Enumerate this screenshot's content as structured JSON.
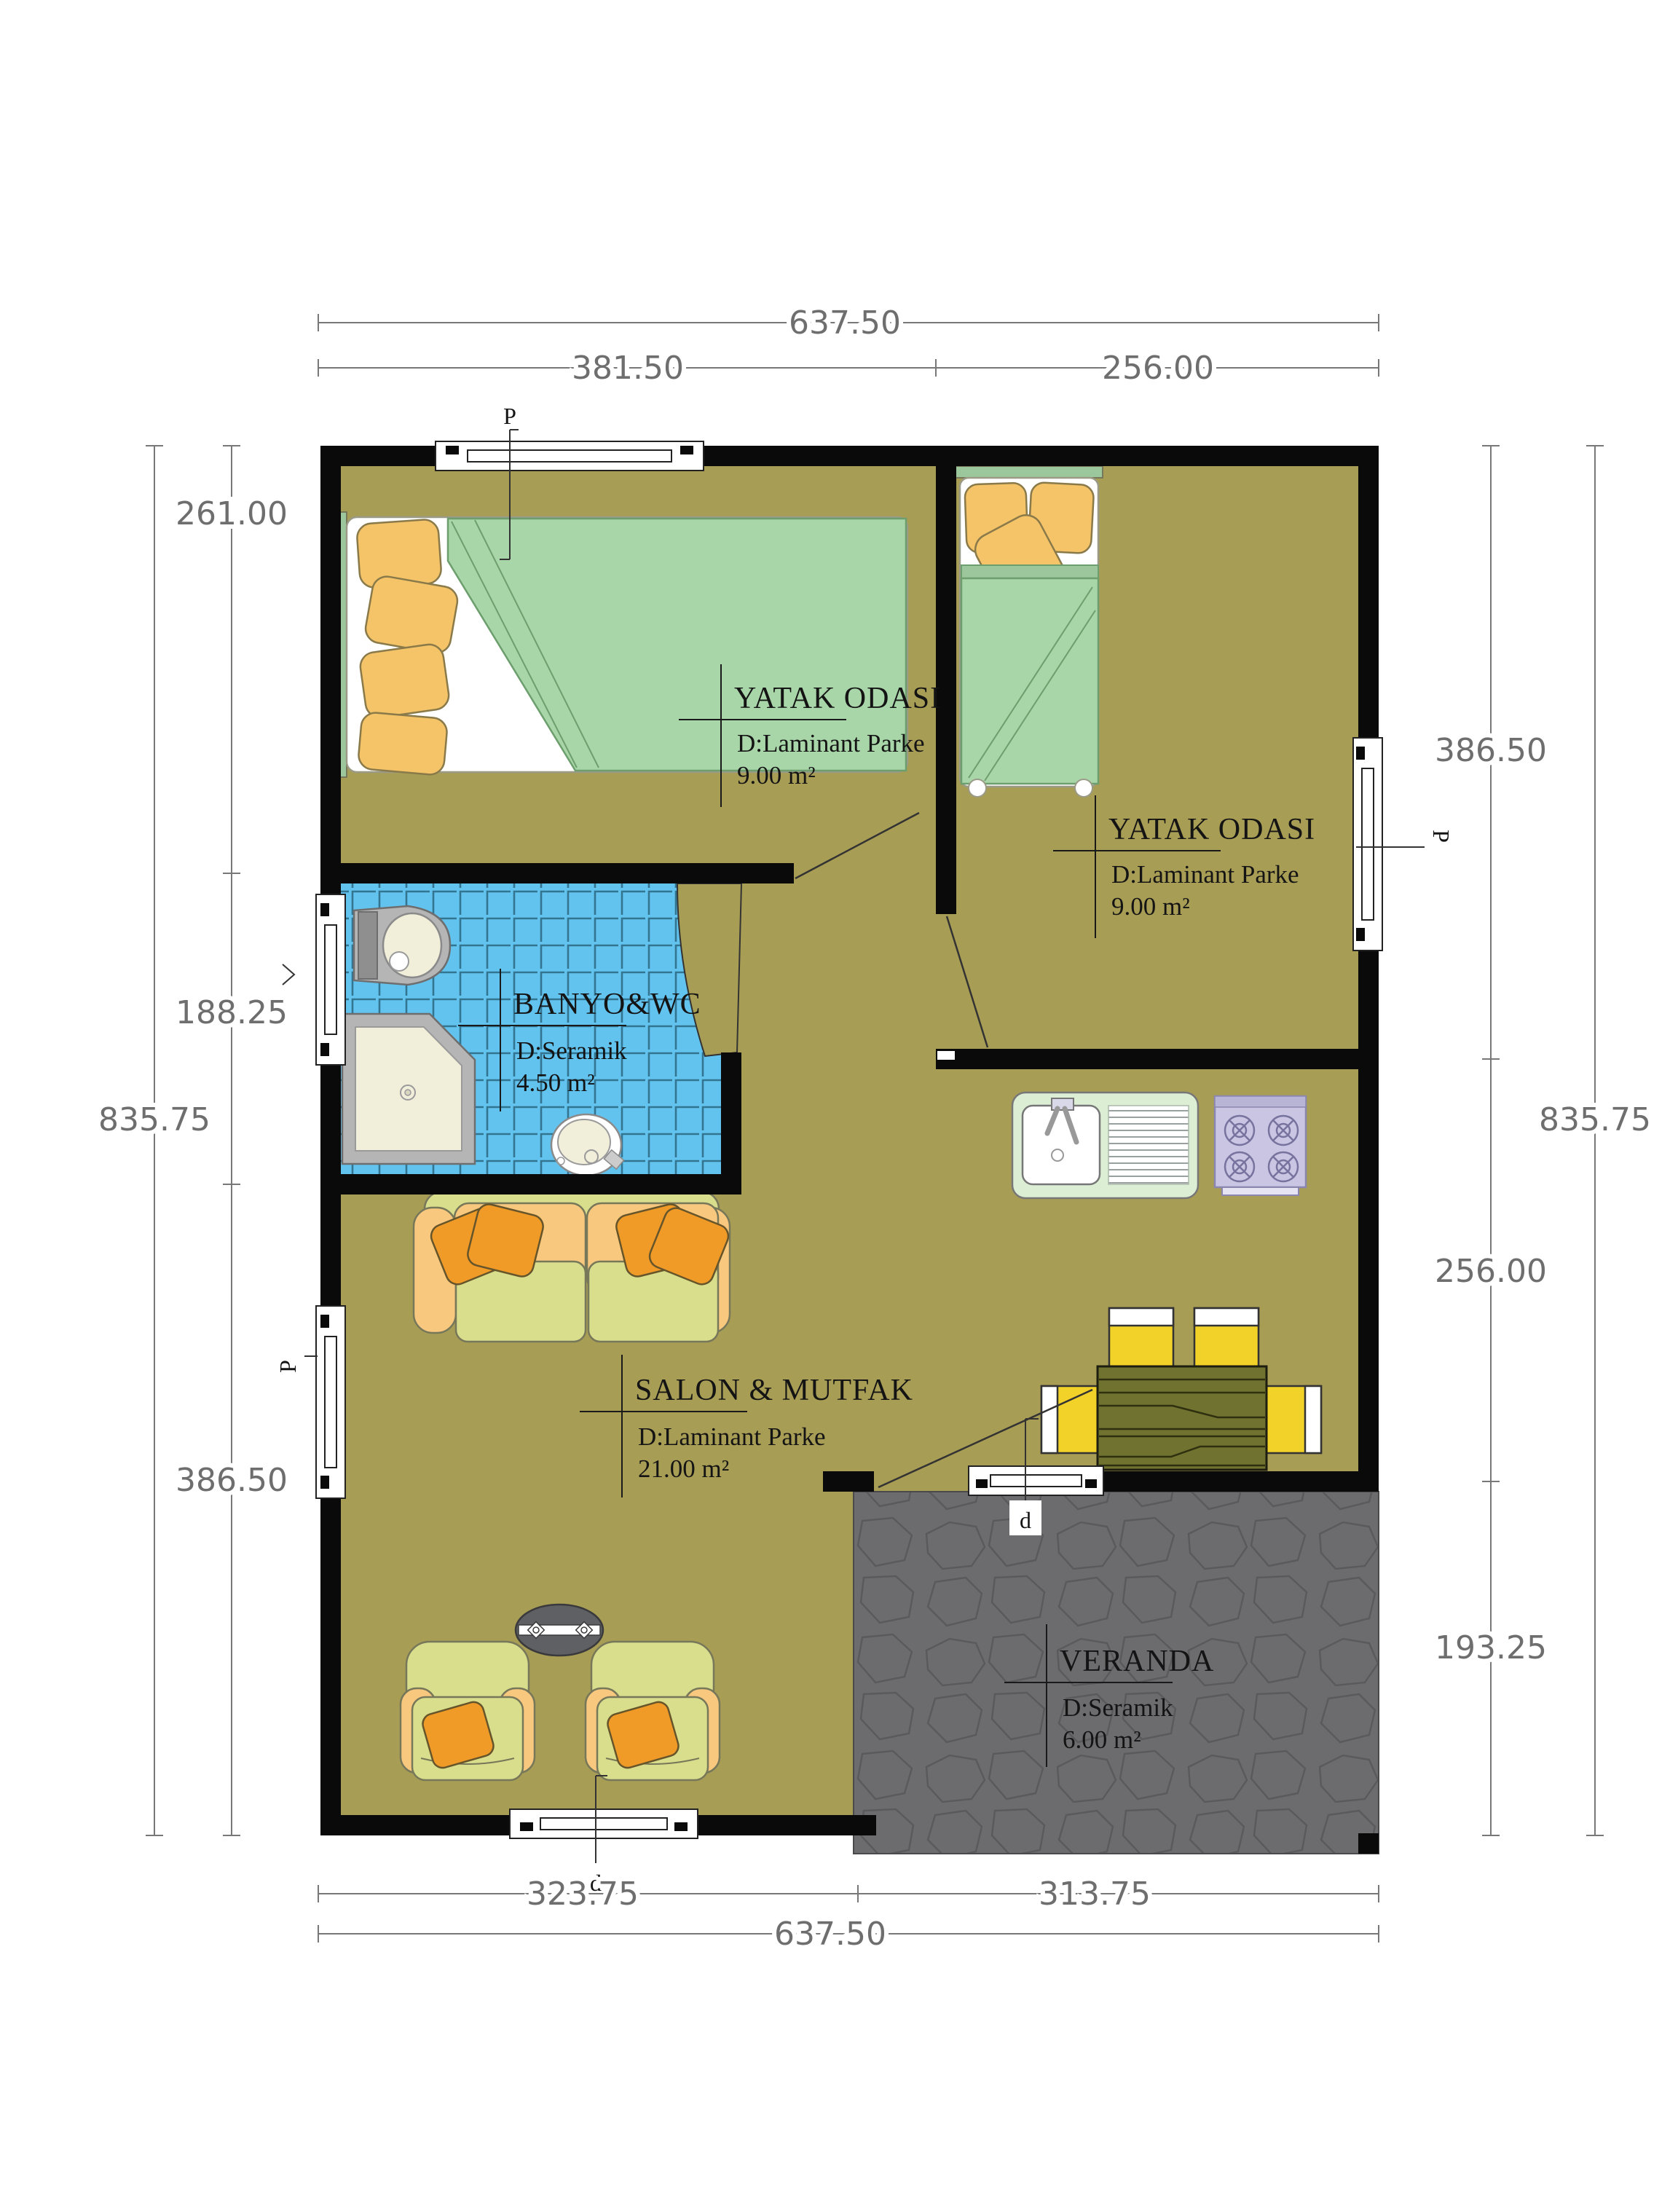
{
  "plan_title": "floor-plan",
  "rooms": {
    "bedroom1": {
      "name": "YATAK ODASI",
      "floor": "D:Laminant Parke",
      "area": "9.00  m²"
    },
    "bedroom2": {
      "name": "YATAK ODASI",
      "floor": "D:Laminant Parke",
      "area": "9.00  m²"
    },
    "bathroom": {
      "name": "BANYO&WC",
      "floor": "D:Seramik",
      "area": "4.50  m²"
    },
    "salon": {
      "name": "SALON & MUTFAK",
      "floor": "D:Laminant Parke",
      "area": "21.00  m²"
    },
    "veranda": {
      "name": "VERANDA",
      "floor": "D:Seramik",
      "area": "6.00  m²"
    }
  },
  "dimensions": {
    "top": {
      "total": "637.50",
      "left": "381.50",
      "right": "256.00"
    },
    "bottom": {
      "left": "323.75",
      "right": "313.75",
      "total": "637.50"
    },
    "left": {
      "upper": "261.00",
      "middle": "188.25",
      "total": "835.75",
      "lower": "386.50"
    },
    "right": {
      "upper": "386.50",
      "total": "835.75",
      "middle": "256.00",
      "lower": "193.25"
    }
  },
  "markers": {
    "window_top": "P",
    "window_left_salon": "P",
    "window_right_bedroom": "P",
    "door_bottom": "d",
    "door_veranda": "d"
  },
  "colors": {
    "wall": "#0a0a0a",
    "floor_olive": "#a89d55",
    "bathroom_tile": "#63c3ef",
    "veranda_stone": "#6c6c6e",
    "sofa_green": "#d9de8c",
    "sofa_arm_orange": "#f8c87e",
    "pillow_orange": "#f09a28",
    "chair_yellow": "#f2d228",
    "bed_blanket_green": "#a9d6a9",
    "bed_pillow_yellow": "#f5c469",
    "counter_green": "#dcefd5",
    "stove_lavender": "#c9c5e2",
    "table_wood": "#70722f",
    "dimension_text": "#6e6e6e"
  }
}
